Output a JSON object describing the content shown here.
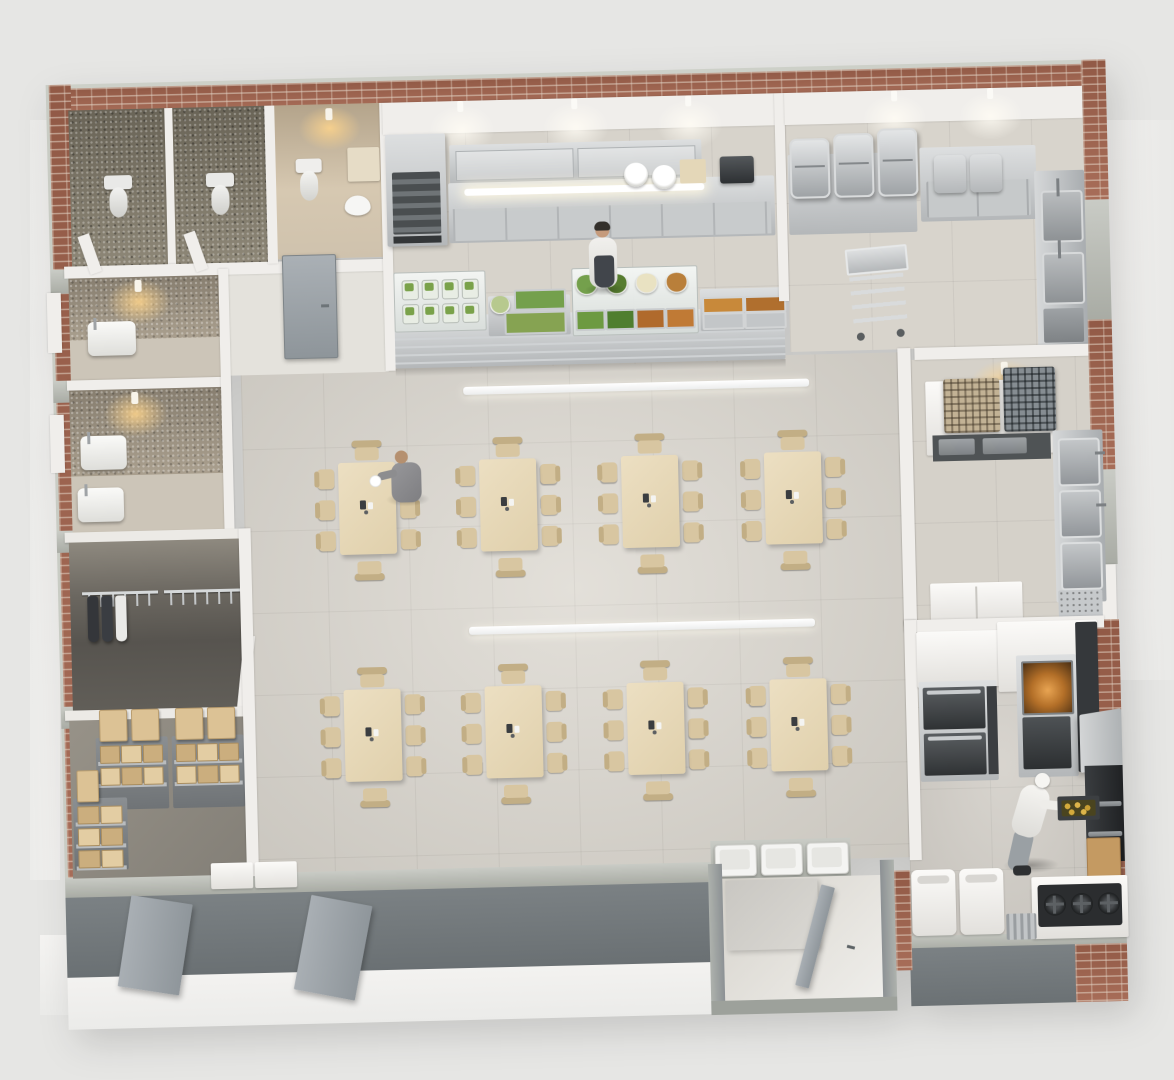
{
  "scene": {
    "type": "3d-isometric-floorplan-render",
    "subject": "cafeteria-canteen",
    "rooms": [
      {
        "id": "wc-stall-1",
        "contents": [
          "toilet"
        ]
      },
      {
        "id": "wc-stall-2",
        "contents": [
          "toilet"
        ]
      },
      {
        "id": "accessible-wc",
        "contents": [
          "toilet",
          "hand-sink",
          "counter"
        ]
      },
      {
        "id": "washroom-upper",
        "contents": [
          "wash-basin",
          "ceiling-light"
        ]
      },
      {
        "id": "washroom-lower",
        "contents": [
          "wash-basin",
          "wash-basin",
          "ceiling-light"
        ]
      },
      {
        "id": "wardrobe-room",
        "contents": [
          "coat-rail",
          "coat-rail",
          "garments"
        ]
      },
      {
        "id": "storage-room",
        "contents": [
          "shelving-rack",
          "shelving-rack",
          "shelving-rack",
          "cardboard-boxes"
        ]
      },
      {
        "id": "serving-kitchen",
        "contents": [
          "upright-cooler",
          "wall-cabinets",
          "counter",
          "plate-stacks",
          "grill-appliance",
          "serving-line",
          "staff"
        ]
      },
      {
        "id": "prep-room",
        "contents": [
          "gn-containers",
          "cabinet",
          "bins",
          "double-sink-station",
          "trolley-cart"
        ]
      },
      {
        "id": "dishwash-room",
        "contents": [
          "dish-racks",
          "counter",
          "triple-sink",
          "base-cabinets",
          "ceiling-light"
        ]
      },
      {
        "id": "hot-kitchen",
        "contents": [
          "double-deck-oven",
          "combi-oven",
          "tall-fridge",
          "extraction-hood",
          "cookline",
          "gas-stove",
          "waste-bins",
          "cardboard-box",
          "chef"
        ]
      },
      {
        "id": "dining-hall",
        "contents": [
          "tables",
          "chairs",
          "pendant-light-bars",
          "diner"
        ]
      },
      {
        "id": "tray-return",
        "contents": [
          "tray",
          "tray",
          "tray"
        ]
      },
      {
        "id": "entry-vestibule",
        "contents": [
          "open-door"
        ]
      }
    ],
    "people": [
      {
        "id": "serving-staff",
        "pose": "standing-behind-serving-line",
        "top": "#f1f0ed",
        "apron": "#41454b",
        "cap": "#33302b",
        "skin": "#c59b7c"
      },
      {
        "id": "diner-suit-man",
        "pose": "seated-at-table-eating",
        "suit": "#8d8d8f",
        "skin": "#b5906f"
      },
      {
        "id": "chef-cook",
        "pose": "loading-tray-into-cookline",
        "coat": "#f0efec",
        "cap": "#f6f5f2",
        "pants": "#9aa0a4",
        "shoes": "#2e3032",
        "tray_food": "#d4aa3c"
      }
    ]
  },
  "palette": {
    "background": "#e6e6e4",
    "slab": "#f4f3f1",
    "brick": "#a2644e",
    "concrete_cap": "#b7bab2",
    "wall_white": "#f0eeeb",
    "outer_wall_gray": "#72787c",
    "floor_dining": "#dcd8d0",
    "floor_kitchen": "#d7d3cb",
    "floor_wardrobe": "#56534e",
    "floor_storage": "#8c8880",
    "wc_tile": "#87806f",
    "accessible_wc_wall": "#cfc1a9",
    "stainless": "#c6c8c9",
    "table_wood": "#e7dabd",
    "chair_wood": "#d8c6a1",
    "door_gray": "#9aa0a5",
    "light_warm": "#ffd58c",
    "light_cool": "#fffcf4"
  },
  "dining": {
    "table_rows": 2,
    "tables_per_row": 4,
    "chairs_per_table": 8,
    "pendant_light_bars": 2,
    "condiment_set_per_table": true
  },
  "serving_line": {
    "cold_display_jars": {
      "rows": 2,
      "cols": 4,
      "content_color": "#7aa24a",
      "jar_color": "#e8ede4"
    },
    "center_display_bowls": [
      "#74a04c",
      "#567c2f",
      "#e9e2c2",
      "#b97f3a"
    ],
    "center_display_trays": [
      "#6d9a41",
      "#4f7e2f",
      "#b06a2c",
      "#c07a35"
    ],
    "mid_counter_items": [
      {
        "type": "bowl",
        "color": "#b7c98e"
      },
      {
        "type": "tray",
        "color": "#74a04c"
      },
      {
        "type": "tray",
        "color": "#86a352"
      }
    ],
    "hot_section_pans": [
      {
        "color": "#c8893a"
      },
      {
        "color": "#b06f2e"
      },
      {
        "color": "#c3c6c8"
      },
      {
        "color": "#c3c6c8"
      }
    ],
    "tray_rails": 3
  },
  "storage": {
    "box_colors": [
      "#dcc295",
      "#cbae7e",
      "#e3cda3"
    ],
    "racks": [
      {
        "id": "rack-a",
        "top_boxes": 2,
        "tier_boxes": 3,
        "tiers": 2
      },
      {
        "id": "rack-b",
        "top_boxes": 2,
        "tier_boxes": 3,
        "tiers": 2
      },
      {
        "id": "rack-c",
        "top_boxes": 1,
        "tier_boxes": 2,
        "tiers": 3
      }
    ]
  },
  "wardrobe": {
    "rails": 2,
    "hangers_per_rail": 6,
    "garments": [
      {
        "color": "#34363a"
      },
      {
        "color": "#3a3d42"
      },
      {
        "color": "#e9e9e7"
      }
    ]
  },
  "hot_kitchen": {
    "stove_burners": 3,
    "oven_decks": 2,
    "combi_glow": "#c97f35",
    "waste_bins": 2
  },
  "prep_room": {
    "gn_containers": 3,
    "sink_stations": 2,
    "top_bins": 2
  },
  "dishwash": {
    "rack_colors": [
      "#c2b295",
      "#868d92"
    ],
    "sink_bowls": 3
  },
  "tray_return": {
    "trays": 3,
    "color": "#f4f4f2"
  }
}
